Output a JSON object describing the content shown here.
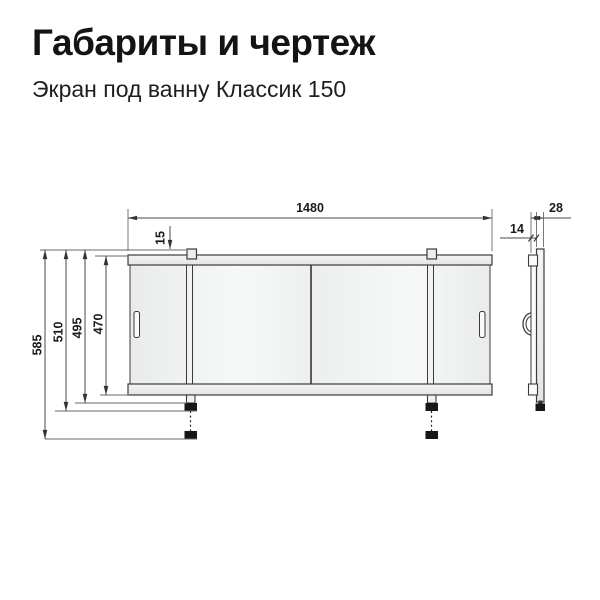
{
  "header": {
    "title": "Габариты и чертеж",
    "subtitle": "Экран под ванну Классик 150"
  },
  "drawing": {
    "front_view": {
      "dim_width": "1480",
      "dim_guide_offset": "15",
      "dim_height_total": "585",
      "dim_height_foot": "510",
      "dim_height_leg": "495",
      "dim_height_panel": "470"
    },
    "side_view": {
      "dim_depth": "28",
      "dim_panel_thickness": "14"
    },
    "colors": {
      "line": "#3b3b3b",
      "dimension_text": "#1a1a1a",
      "panel_fill": "#f3f4f4",
      "background": "#ffffff"
    }
  }
}
